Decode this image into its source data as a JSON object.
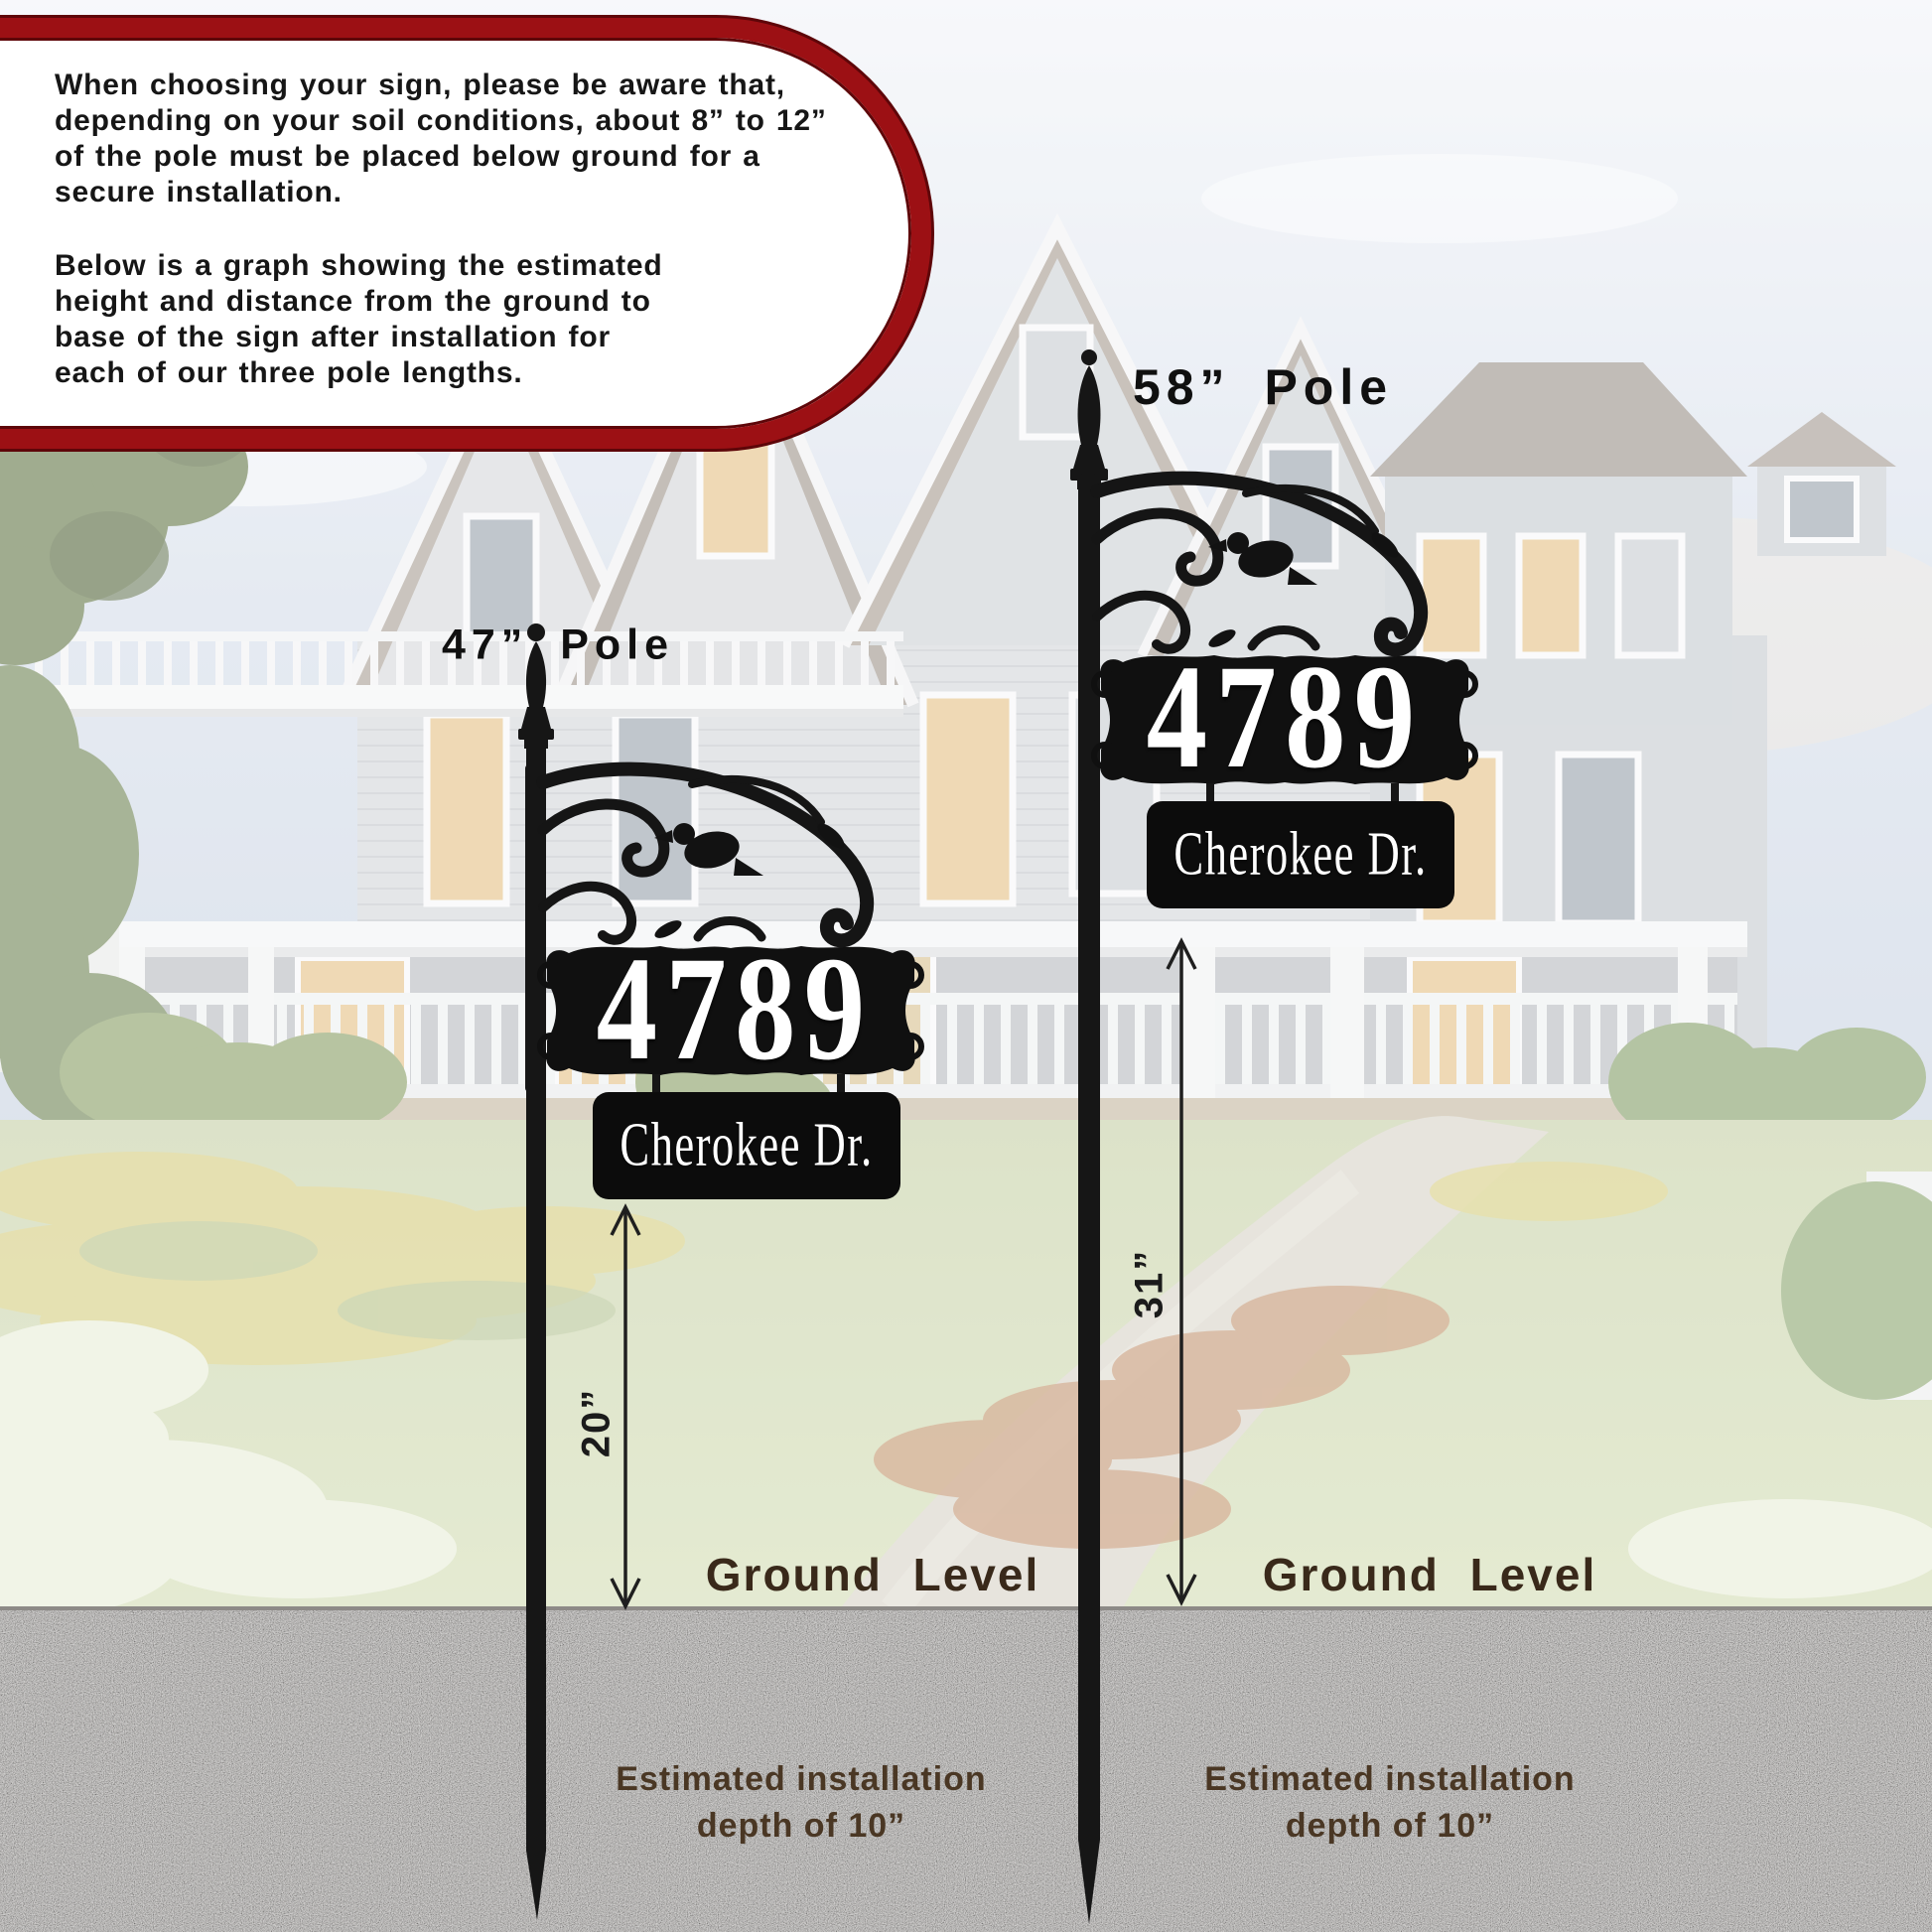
{
  "callout": {
    "lines1": [
      "When choosing your sign, please be aware that,",
      "depending on your soil conditions, about 8” to 12”",
      "of the pole must be placed below ground for a",
      "secure installation."
    ],
    "lines2": [
      "Below is a graph showing the estimated",
      "height and distance from the ground to",
      "base of the sign after installation for",
      "each of our three pole lengths."
    ]
  },
  "signs": {
    "left": {
      "pole_label": "47” Pole",
      "house_number": "4789",
      "street_name": "Cherokee Dr.",
      "height_above_ground": "20”",
      "ground_label": "Ground Level",
      "install_line1": "Estimated installation",
      "install_line2": "depth of 10”"
    },
    "right": {
      "pole_label": "58” Pole",
      "house_number": "4789",
      "street_name": "Cherokee Dr.",
      "height_above_ground": "31”",
      "ground_label": "Ground Level",
      "install_line1": "Estimated installation",
      "install_line2": "depth of 10”"
    }
  },
  "colors": {
    "callout_border": "#9c1014",
    "sign_black": "#141414",
    "ground_text": "#39291a",
    "install_text": "#4a3724",
    "gravel_base": "#a7a4a1"
  }
}
